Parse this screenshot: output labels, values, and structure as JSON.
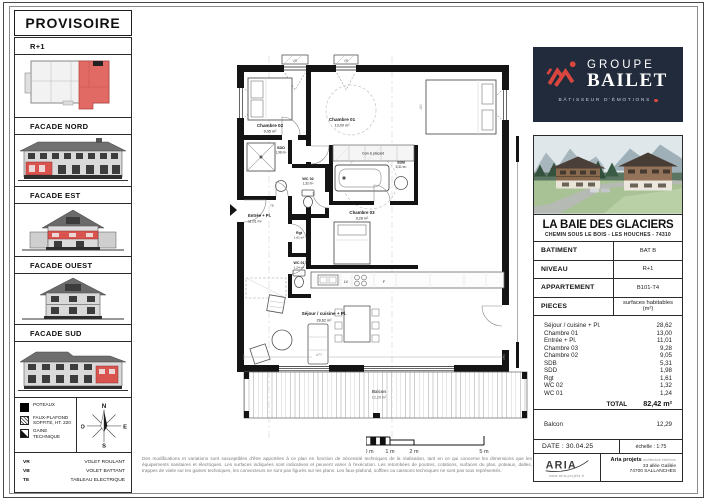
{
  "sheet": {
    "status_title": "PROVISOIRE"
  },
  "sidebar": {
    "level": {
      "label": "R+1"
    },
    "facades": [
      {
        "label": "FACADE NORD"
      },
      {
        "label": "FACADE EST"
      },
      {
        "label": "FACADE OUEST"
      },
      {
        "label": "FACADE SUD"
      }
    ],
    "legend": {
      "items": [
        {
          "label": "POTEAUX"
        },
        {
          "label": "FAUX-PLAFOND SOFFITE, HT. 220"
        },
        {
          "label": "GAINE TECHNIQUE"
        }
      ]
    },
    "compass": {
      "n": "N",
      "o": "O",
      "e": "E",
      "s": "S"
    },
    "abbreviations": [
      {
        "abbr": "VR",
        "label": "VOLET ROULANT"
      },
      {
        "abbr": "VB",
        "label": "VOLET BATTANT"
      },
      {
        "abbr": "TE",
        "label": "TABLEAU ELECTRIQUE"
      }
    ]
  },
  "plan": {
    "rooms": {
      "chambre02": {
        "name": "Chambre 02",
        "area": "9,05 m²"
      },
      "chambre01": {
        "name": "Chambre 01",
        "area": "13,00 m²"
      },
      "sdd": {
        "name": "SDD",
        "area": "1,98 m²"
      },
      "wc02": {
        "name": "WC 02",
        "area": "1,32 m²"
      },
      "placard": {
        "name": "Coin & placard"
      },
      "sdb": {
        "name": "SDB",
        "area": "5,31 m²"
      },
      "entree": {
        "name": "Entrée + Pl.",
        "area": "11,01 m²"
      },
      "rgt": {
        "name": "Rgt",
        "area": "1,61 m²"
      },
      "wc01": {
        "name": "WC 01",
        "area": "1,24 m²"
      },
      "chambre03": {
        "name": "Chambre 03",
        "area": "9,28 m²"
      },
      "sejour": {
        "name": "Séjour / cuisine + Pl.",
        "area": "28,62 m²"
      },
      "balcon": {
        "name": "Balcon",
        "area": "12,29 m²"
      }
    },
    "kitchen": {
      "lv": "LV",
      "f": "F"
    },
    "markers": {
      "vr": "VR",
      "te": "TE"
    },
    "dims": {
      "sejour_width": "477",
      "bed_width": "160"
    }
  },
  "scalebar": {
    "t0": "0 m",
    "t1": "1 m",
    "t2": "2 m",
    "t5": "5 m"
  },
  "disclaimer": "Des modifications et variations sont susceptibles d'être apportées à ce plan en fonction de nécessité techniques de la réalisation, tant en ce qui concerne les dimensions que les équipements sanitaires et électriques. Les surfaces indiquées sont indicatives et peuvent varier à l'exécution. Les retombées de poutres, cotations, surfaces du plan, poteaux, dalles, trappes de visite sur les gaines techniques, les convecteurs ne sont pas figurés sur les plans. Les faux-plafond, soffites ou caissons techniques ne sont pas tous représentés.",
  "titleblock": {
    "brand": {
      "group": "GROUPE",
      "name": "BAILET",
      "tagline": "BÂTISSEUR D'ÉMOTIONS"
    },
    "project": {
      "title": "LA BAIE DES GLACIERS",
      "address": "CHEMIN SOUS LE BOIS - LES HOUCHES - 74310"
    },
    "info_rows": [
      {
        "label": "BATIMENT",
        "value": "BAT B"
      },
      {
        "label": "NIVEAU",
        "value": "R+1"
      },
      {
        "label": "APPARTEMENT",
        "value": "B101-T4"
      },
      {
        "label": "PIECES",
        "value": "surfaces habitables (m²)"
      }
    ],
    "surfaces": [
      {
        "label": "Séjour / cuisine + Pl.",
        "value": "28,62"
      },
      {
        "label": "Chambre 01",
        "value": "13,00"
      },
      {
        "label": "Entrée + Pl.",
        "value": "11,01"
      },
      {
        "label": "Chambre 03",
        "value": "9,28"
      },
      {
        "label": "Chambre 02",
        "value": "9,05"
      },
      {
        "label": "SDB",
        "value": "5,31"
      },
      {
        "label": "SDD",
        "value": "1,98"
      },
      {
        "label": "Rgt",
        "value": "1,61"
      },
      {
        "label": "WC 02",
        "value": "1,32"
      },
      {
        "label": "WC 01",
        "value": "1,24"
      }
    ],
    "total": {
      "label": "TOTAL",
      "value": "82,42 m²"
    },
    "balcony": {
      "label": "Balcon",
      "value": "12,29"
    },
    "date": "DATE : 30.04.25",
    "scale": "échelle : 1:75",
    "agency": {
      "logo_text": "ARIA",
      "website": "www.aria-projets.fr",
      "name": "Aria projets",
      "descriptor": "architecture intérieure",
      "address_line1": "33 allée Galilée",
      "address_line2": "74700 SALLANCHES"
    }
  },
  "colors": {
    "accent_red": "#D9463F",
    "facade_red": "#D9534F",
    "brand_navy": "#222B3B"
  }
}
